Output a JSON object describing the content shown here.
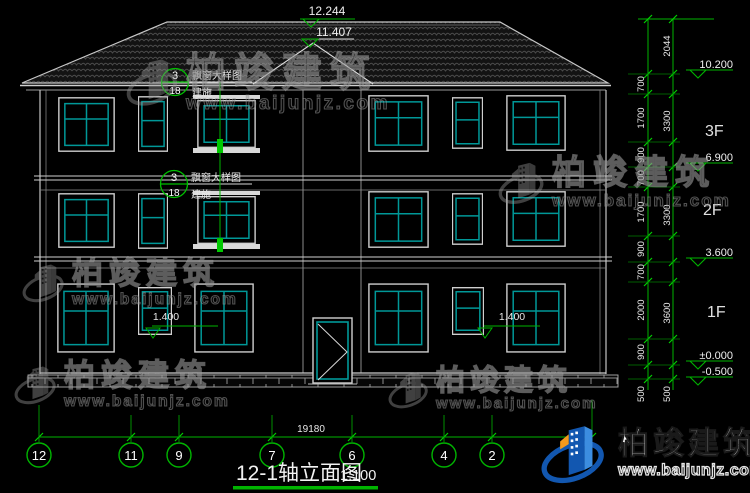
{
  "drawing": {
    "title": "12-1轴立面图",
    "scale": "1:100",
    "total_width_dim": "19180",
    "axis_bubbles": [
      "12",
      "11",
      "9",
      "7",
      "6",
      "4",
      "2"
    ],
    "roof_levels": {
      "ridge": "12.244",
      "lower": "11.407"
    },
    "levels": {
      "eave": "10.200",
      "f3": "6.900",
      "f2": "3.600",
      "ground": "±0.000",
      "base": "-0.500"
    },
    "floor_labels": {
      "f3": "3F",
      "f2": "2F",
      "f1": "1F"
    },
    "seg_dims": [
      "700",
      "1700",
      "900",
      "700",
      "1700",
      "900",
      "700",
      "2000",
      "900"
    ],
    "seg_500_inner": "500",
    "total_dims": {
      "top": "2044",
      "f3": "3300",
      "f2": "3300",
      "f1": "3600",
      "base": "500"
    },
    "window_sill_dims": [
      "1.400",
      "1.400"
    ],
    "callout": {
      "num": "3",
      "sheet": "18",
      "label": "飘窗大样图",
      "sublabel": "建施"
    }
  },
  "watermark": {
    "name": "柏竣建筑",
    "url": "www.baijunjz.com"
  },
  "logo": {
    "name": "柏竣建筑",
    "url": "www.baijunjz.com"
  },
  "colors": {
    "background": "#000000",
    "line": "#d9d9d9",
    "dim_green": "#00b400",
    "window_teal": "#009898",
    "logo_blue": "#1257b0",
    "logo_orange": "#f5991c"
  }
}
